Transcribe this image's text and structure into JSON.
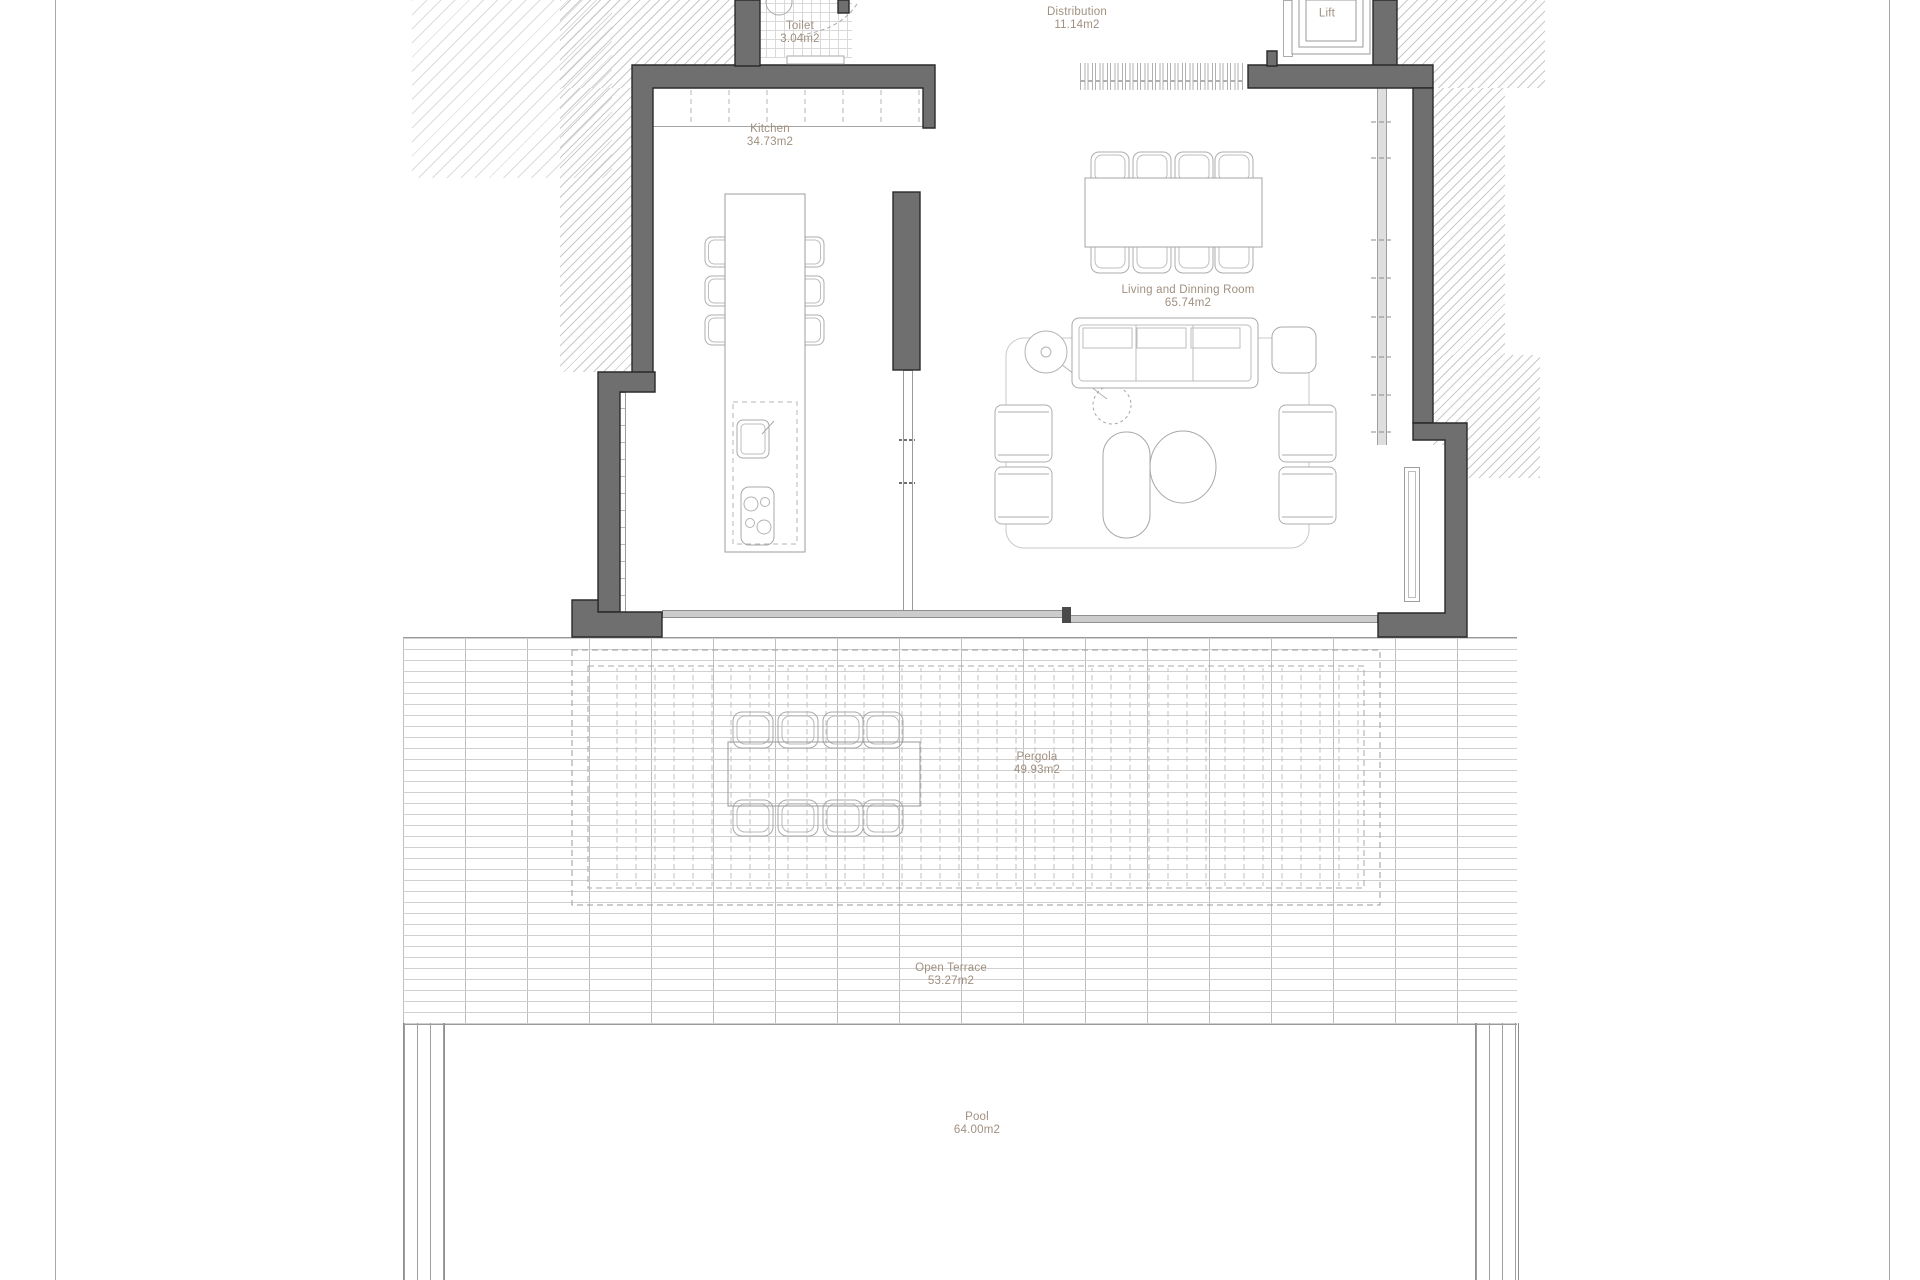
{
  "drawing": {
    "type": "floor-plan",
    "colors": {
      "wall_fill": "#6f6f6f",
      "wall_outline": "#2a2a2a",
      "label_text": "#a09080",
      "furniture_line": "#adadad"
    }
  },
  "rooms": [
    {
      "name": "Toilet",
      "area": "3.04m2"
    },
    {
      "name": "Distribution",
      "area": "11.14m2"
    },
    {
      "name": "Lift",
      "area": ""
    },
    {
      "name": "Kitchen",
      "area": "34.73m2"
    },
    {
      "name": "Living and Dinning Room",
      "area": "65.74m2"
    },
    {
      "name": "Pergola",
      "area": "49.93m2"
    },
    {
      "name": "Open Terrace",
      "area": "53.27m2"
    },
    {
      "name": "Pool",
      "area": "64.00m2"
    }
  ]
}
